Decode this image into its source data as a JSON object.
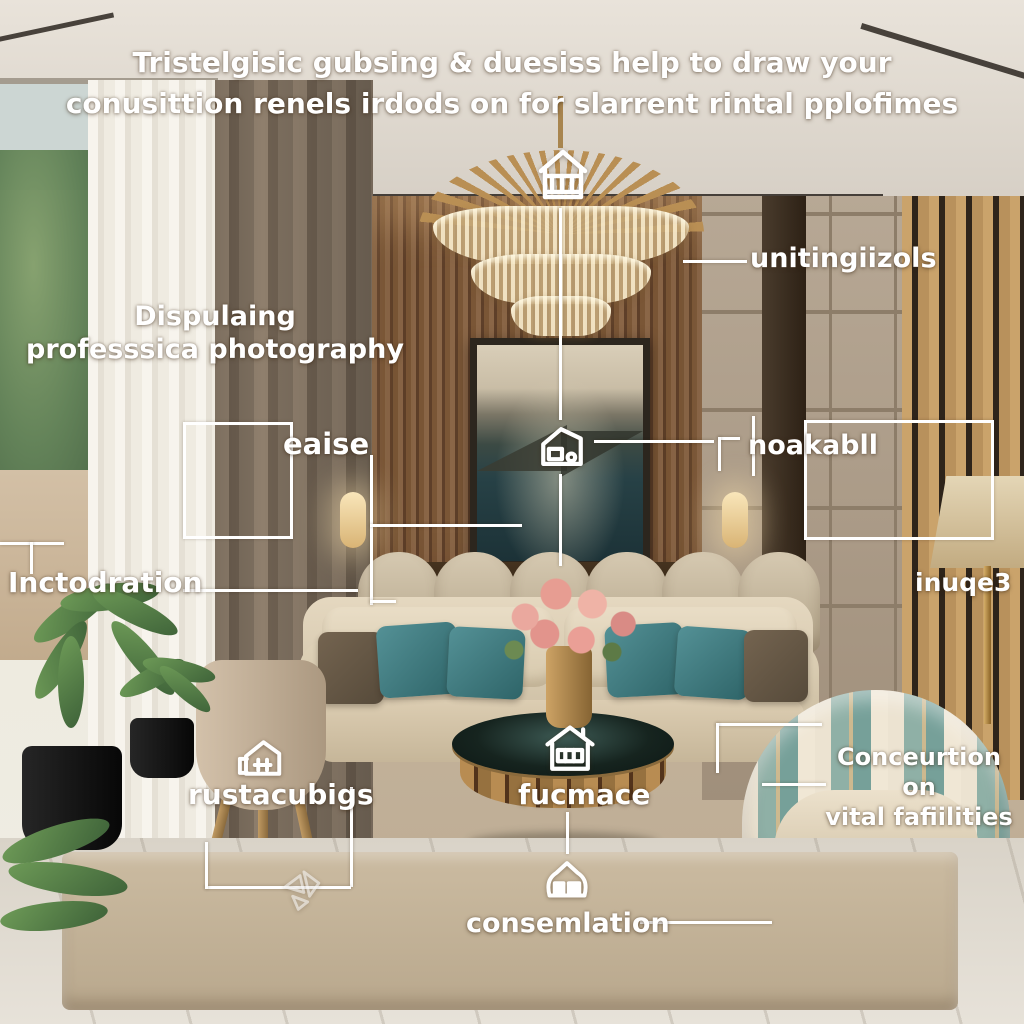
{
  "title": {
    "line1": "Tristelgisic gubsing & duesiss help to draw your",
    "line2": "conusittion renels irdods on  for slarrent rintal pplofimes"
  },
  "annotations": {
    "unitingiizols": "unitingiizols",
    "dispulaing_line1": "Dispulaing",
    "dispulaing_line2": "professsica photography",
    "eaise": "eaise",
    "noakabll": "noakabll",
    "inctodration": "Inctodration",
    "inuqe3": "inuqe3",
    "rustacubigs": "rustacubigs",
    "fucmace": "fucmace",
    "conceurtion_line1": "Conceurtion on",
    "conceurtion_line2": "vital fafiilities",
    "consemlation": "consemlation"
  },
  "icons": {
    "chandelier_house": "house-with-columns-icon",
    "picture_house": "house-sketch-icon",
    "table_house": "house-window-icon",
    "rounded_house": "rounded-house-icon",
    "stool_house": "house-interior-icon",
    "glass_shards": "glass-shards-icon"
  },
  "colors": {
    "annotation_text": "#ffffff",
    "annotation_lines": "#ffffff",
    "teal_pillow": "#3f7e83",
    "sofa_beige": "#d8c9b0",
    "wood_wall": "#7a5636",
    "table_gold": "#b08850",
    "rug": "#c6b69d"
  }
}
